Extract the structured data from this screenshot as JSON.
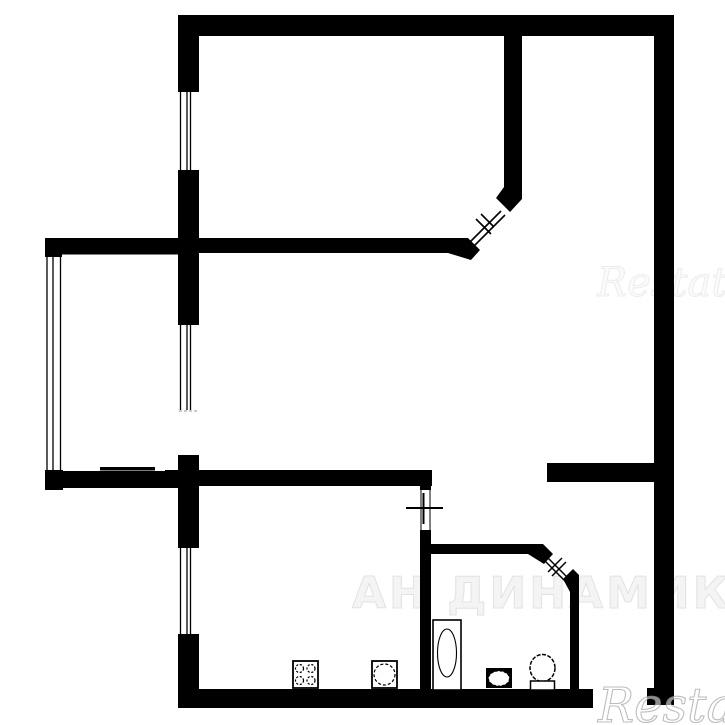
{
  "canvas": {
    "width": 725,
    "height": 725,
    "background_color": "#ffffff",
    "wall_color": "#000000"
  },
  "watermarks": {
    "center": {
      "text": "АН ДИНАМИКА",
      "fill": "#f4f4f4",
      "outline": "#e2e2e2"
    },
    "middle_right": {
      "text": "Restate",
      "fill": "#fbfbfb",
      "outline": "#ececec"
    },
    "bottom_right": {
      "text": "Restate",
      "fill": "rgba(255,255,255,0.55)",
      "outline": "#9a9a9a"
    }
  },
  "plan": {
    "type": "apartment-floor-plan",
    "drawing_style": "black solid walls on white, no dimension text",
    "fixtures": [
      {
        "name": "stove-4-burner",
        "room": "kitchen"
      },
      {
        "name": "kitchen-sink",
        "room": "kitchen"
      },
      {
        "name": "bathtub",
        "room": "bathroom"
      },
      {
        "name": "washbasin",
        "room": "bathroom"
      },
      {
        "name": "toilet",
        "room": "bathroom"
      }
    ],
    "windows": [
      "upper-room-window-left-wall",
      "living-room-window-left-wall",
      "kitchen-window-left-wall",
      "balcony-glazing-far-left"
    ],
    "doors": [
      "upper-room-diagonal-door",
      "balcony-door-opening",
      "kitchen-door-cross-mark",
      "bathroom-diagonal-door",
      "entrance-opening-bottom-right"
    ]
  }
}
